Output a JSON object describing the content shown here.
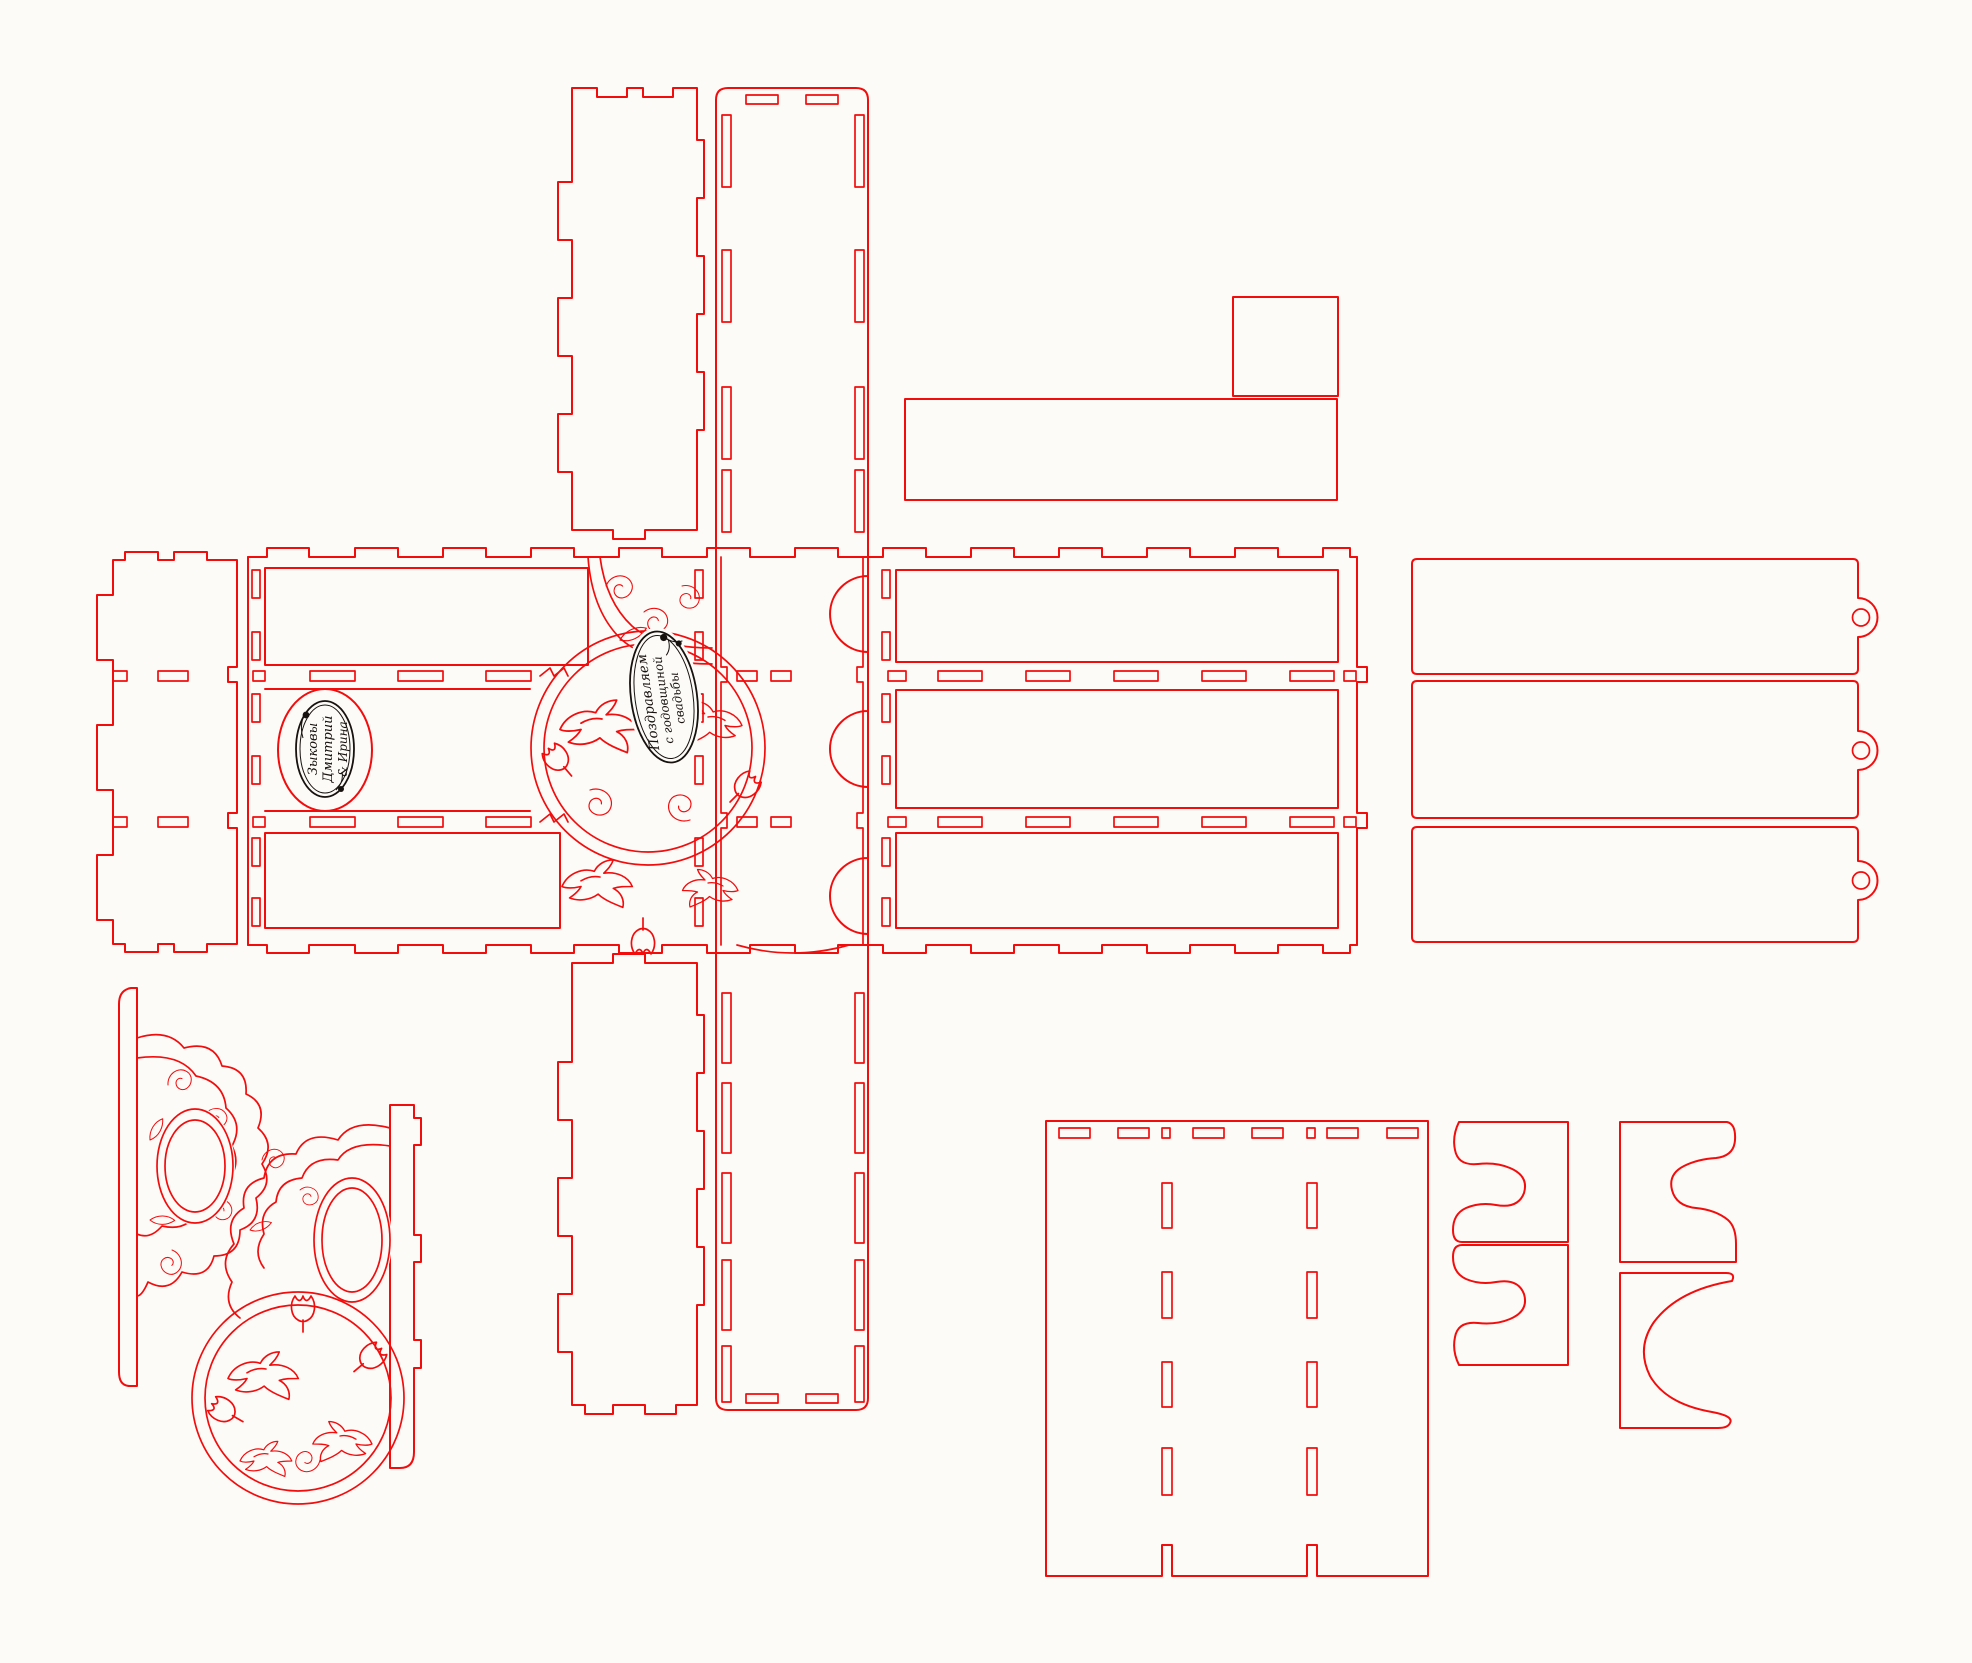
{
  "document": {
    "background": "#fcfbf8",
    "cut_color": "#f20d0d",
    "engrave_color": "#17120f"
  },
  "plaques": {
    "names": {
      "line1": "Зыковы",
      "line2": "Дмитрий",
      "line3": "& Ирина"
    },
    "greeting": {
      "line1": "Поздравляем",
      "line2": "с годовщиной",
      "line3": "свадьбы"
    }
  }
}
